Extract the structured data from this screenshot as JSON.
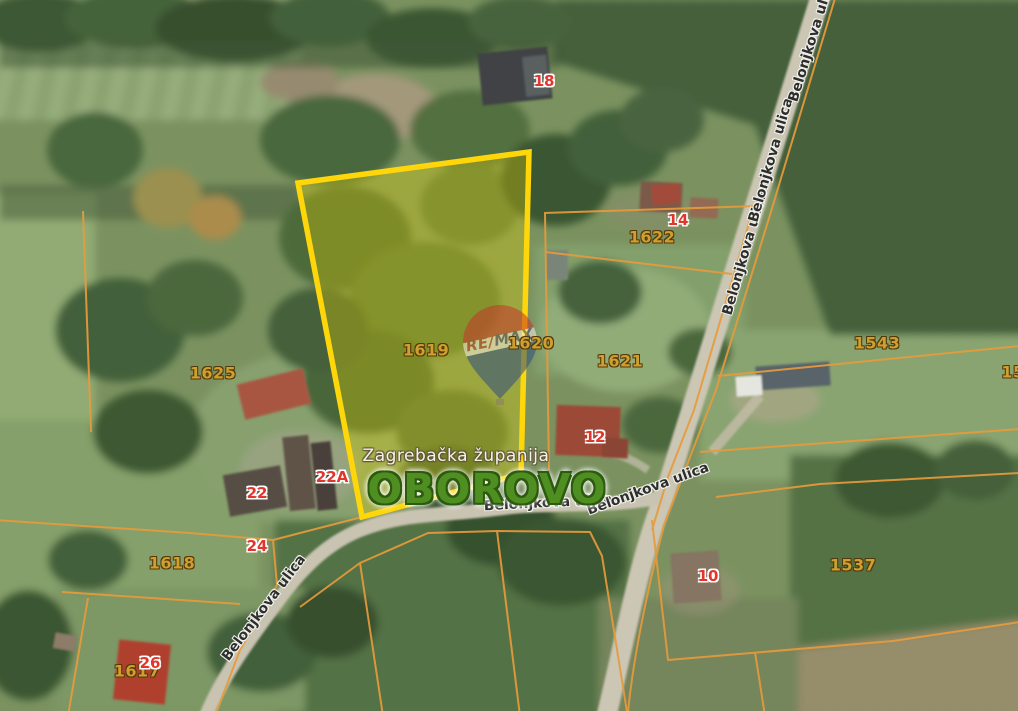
{
  "map": {
    "settlement_label": "OBOROVO",
    "region_label": "Zagrebačka županija",
    "street_name": "Belonjkova ulica",
    "parcel_labels": [
      {
        "id": "1619",
        "highlighted": true
      },
      {
        "id": "1620",
        "highlighted": false
      },
      {
        "id": "1621",
        "highlighted": false
      },
      {
        "id": "1622",
        "highlighted": false
      },
      {
        "id": "1625",
        "highlighted": false
      },
      {
        "id": "1618",
        "highlighted": false
      },
      {
        "id": "1617",
        "highlighted": false
      },
      {
        "id": "1543",
        "highlighted": false
      },
      {
        "id": "1537",
        "highlighted": false
      },
      {
        "id": "15",
        "highlighted": false,
        "partial": true
      }
    ],
    "house_numbers": [
      "18",
      "14",
      "12",
      "22A",
      "22",
      "24",
      "26",
      "10"
    ],
    "logo": {
      "brand": "RE/MAX",
      "re": "RE",
      "slash": "/",
      "max": "MAX"
    },
    "highlight": {
      "parcel_id": "1619",
      "border_color": "#ffd60a",
      "fill_color": "rgba(228,210,0,0.33)"
    },
    "colors": {
      "parcel_line": "#e79b3c",
      "parcel_number": "#cf9f2f",
      "house_number": "#e2352b",
      "street_label": "#2e2e2e",
      "settlement_text": "#4f8f22",
      "region_text": "#f7f3e4",
      "road": "#ccc6b4",
      "balloon_red": "#c8362a",
      "balloon_blue": "#2e4f80"
    }
  }
}
